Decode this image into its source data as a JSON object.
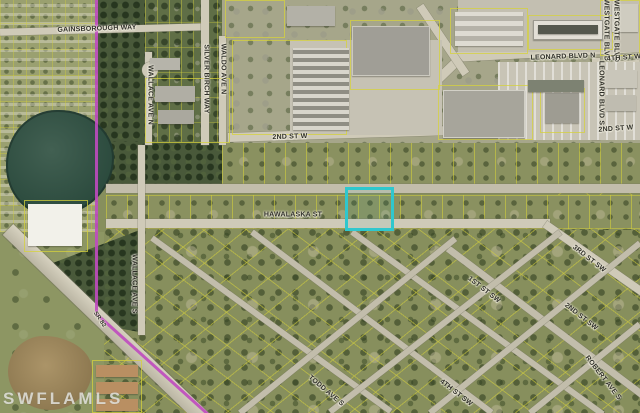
{
  "map": {
    "watermark": "SWFLAMLS",
    "highlight_color": "#2fc7cd",
    "boundary_color": "#bf4abf",
    "parcel_line_color": "#d6d33c",
    "street_labels": [
      {
        "id": "gainsborough-way",
        "text": "GAINSBOROUGH WAY"
      },
      {
        "id": "silver-birch-way",
        "text": "SILVER BIRCH WAY"
      },
      {
        "id": "wallace-ave-n",
        "text": "WALLACE AVE N"
      },
      {
        "id": "waldo-ave-n",
        "text": "WALDO AVE N"
      },
      {
        "id": "second-st-w",
        "text": "2ND ST W"
      },
      {
        "id": "second-st-w-east",
        "text": "2ND ST W"
      },
      {
        "id": "leonard-blvd-n",
        "text": "LEONARD BLVD N"
      },
      {
        "id": "leonard-blvd-s",
        "text": "LEONARD BLVD S"
      },
      {
        "id": "westgate-blvd-west",
        "text": "WESTGATE BLVD"
      },
      {
        "id": "westgate-blvd-east",
        "text": "WESTGATE BLVD"
      },
      {
        "id": "fourth-st-w",
        "text": "4TH ST W"
      },
      {
        "id": "hawalaska-st",
        "text": "HAWALASKA ST"
      },
      {
        "id": "first-st-sw",
        "text": "1ST ST SW"
      },
      {
        "id": "second-st-sw",
        "text": "2ND ST SW"
      },
      {
        "id": "third-st-sw",
        "text": "3RD ST SW"
      },
      {
        "id": "fourth-st-sw",
        "text": "4TH ST SW"
      },
      {
        "id": "robert-ave-s",
        "text": "ROBERT AVE S"
      },
      {
        "id": "todd-ave-s",
        "text": "TODD AVE S"
      },
      {
        "id": "wallace-ave-s",
        "text": "WALLACE AVE S"
      },
      {
        "id": "sr-82",
        "text": "SR 82"
      }
    ]
  }
}
